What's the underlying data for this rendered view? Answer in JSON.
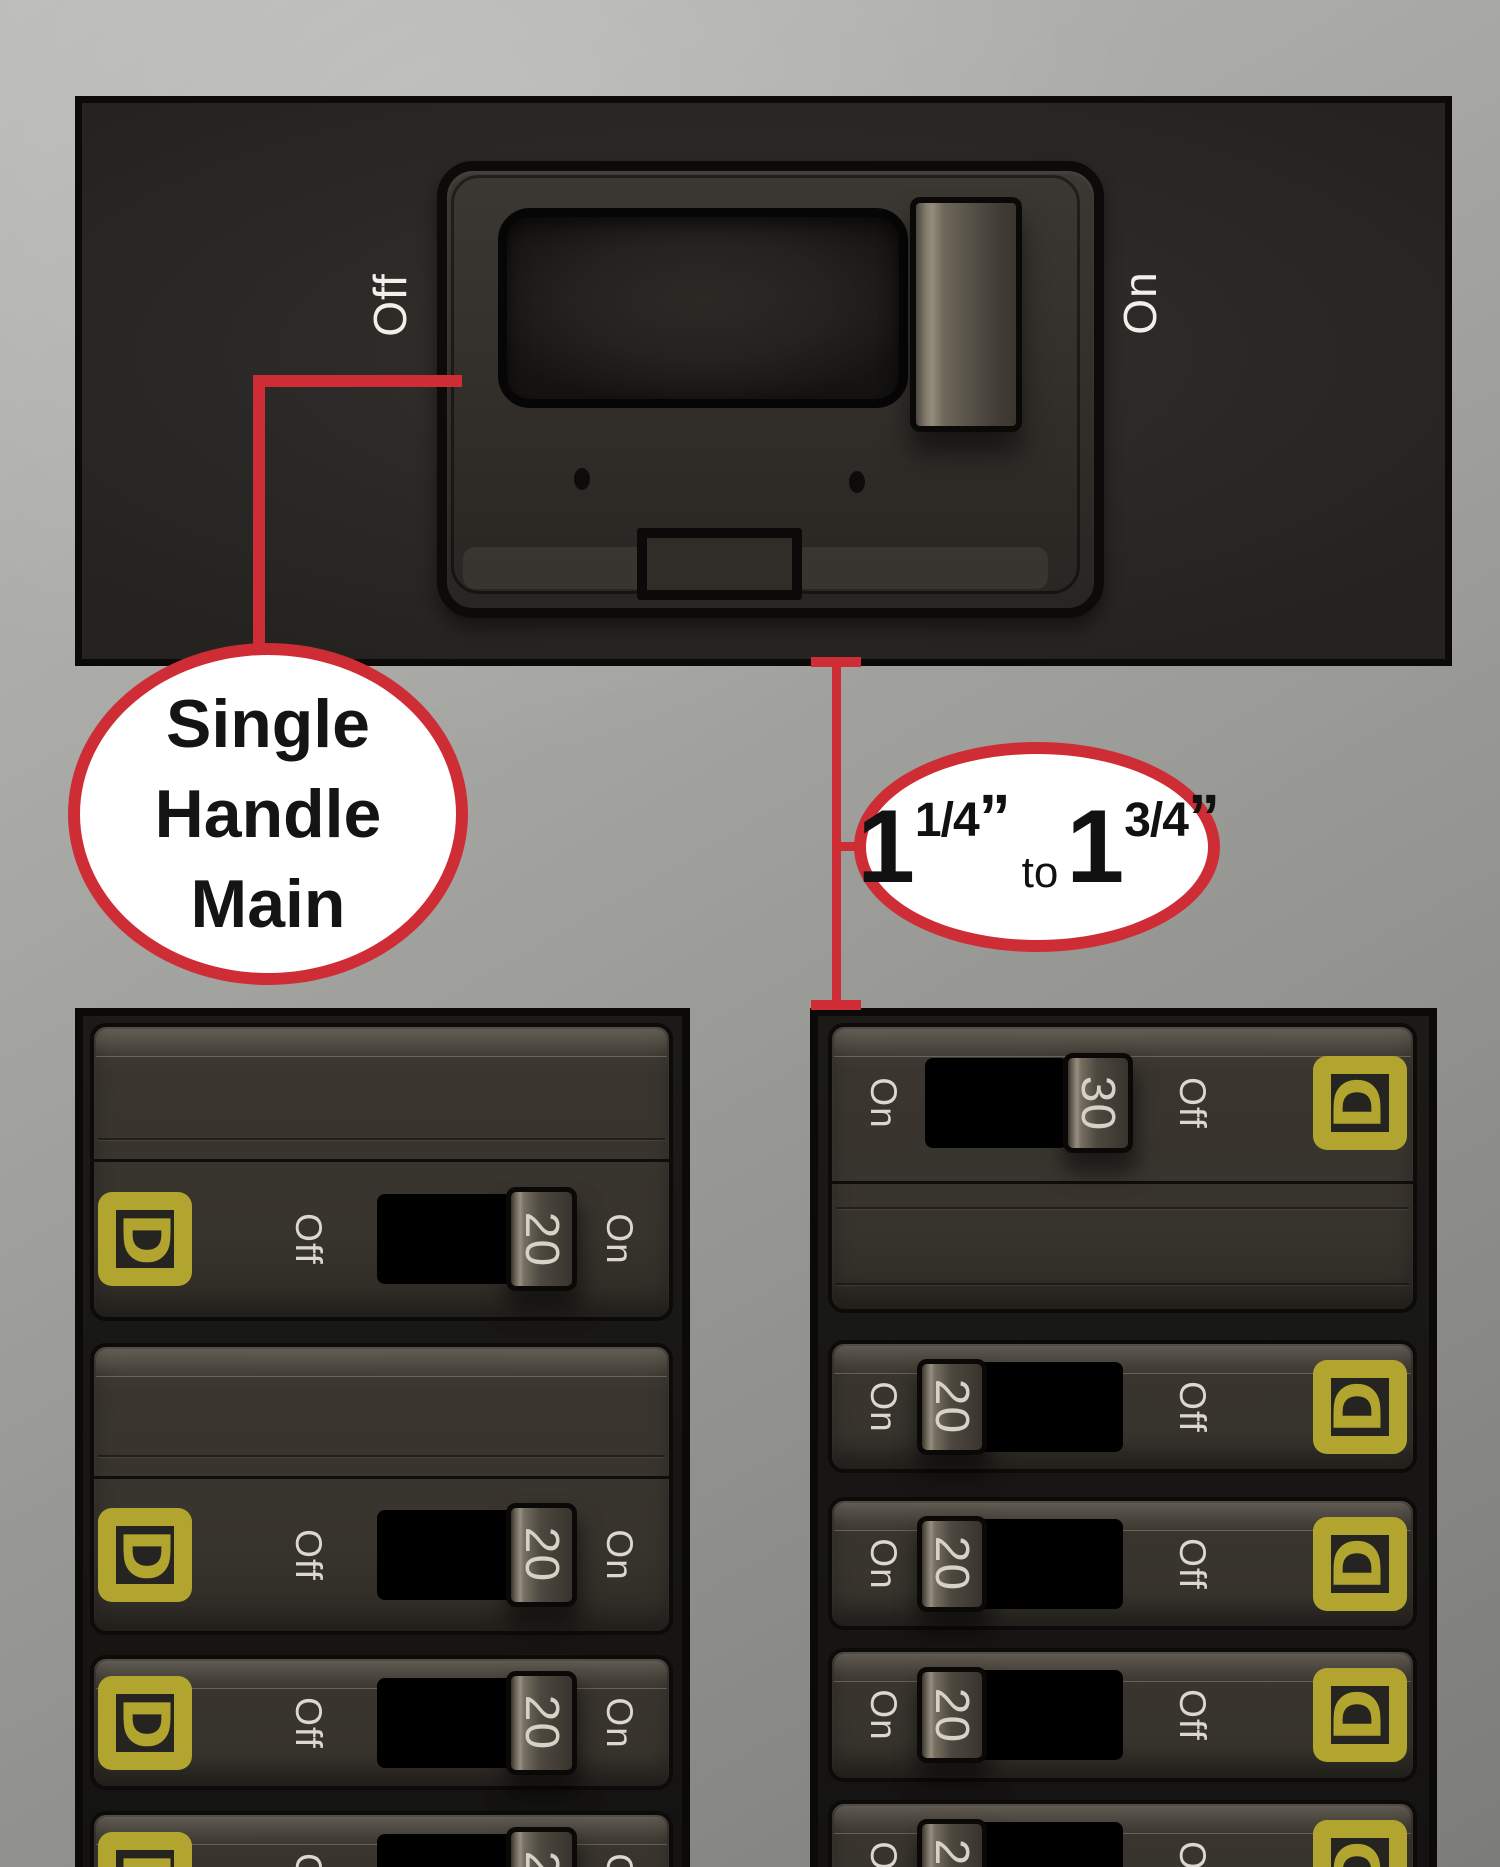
{
  "top_panel": {
    "off_label": "Off",
    "on_label": "On"
  },
  "callout_main": {
    "line1": "Single",
    "line2": "Handle",
    "line3": "Main"
  },
  "callout_measure": {
    "first_whole": "1",
    "first_frac": "1/4",
    "first_quote": "”",
    "connector": "to",
    "second_whole": "1",
    "second_frac": "3/4",
    "second_quote": "”"
  },
  "left_panel": {
    "units": [
      {
        "off_label": "Off",
        "amp": "20",
        "on_label": "On"
      },
      {
        "off_label": "Off",
        "amp": "20",
        "on_label": "On"
      },
      {
        "off_label": "Off",
        "amp": "20",
        "on_label": "On"
      },
      {
        "off_label": "Off",
        "amp": "20",
        "on_label": "On"
      }
    ]
  },
  "right_panel": {
    "units": [
      {
        "on_label": "On",
        "amp": "30",
        "off_label": "Off"
      },
      {
        "on_label": "On",
        "amp": "20",
        "off_label": "Off"
      },
      {
        "on_label": "On",
        "amp": "20",
        "off_label": "Off"
      },
      {
        "on_label": "On",
        "amp": "20",
        "off_label": "Off"
      },
      {
        "on_label": "On",
        "amp": "20",
        "off_label": "Off"
      }
    ]
  },
  "logo": {
    "letter": "D",
    "brand_name": "square-d-logo"
  },
  "colors": {
    "accent_red": "#cf2d35",
    "logo_yellow": "#b2a52f",
    "label_light": "#dcd8d0",
    "panel_black": "#0b0a09",
    "callout_fill": "#ffffff"
  }
}
